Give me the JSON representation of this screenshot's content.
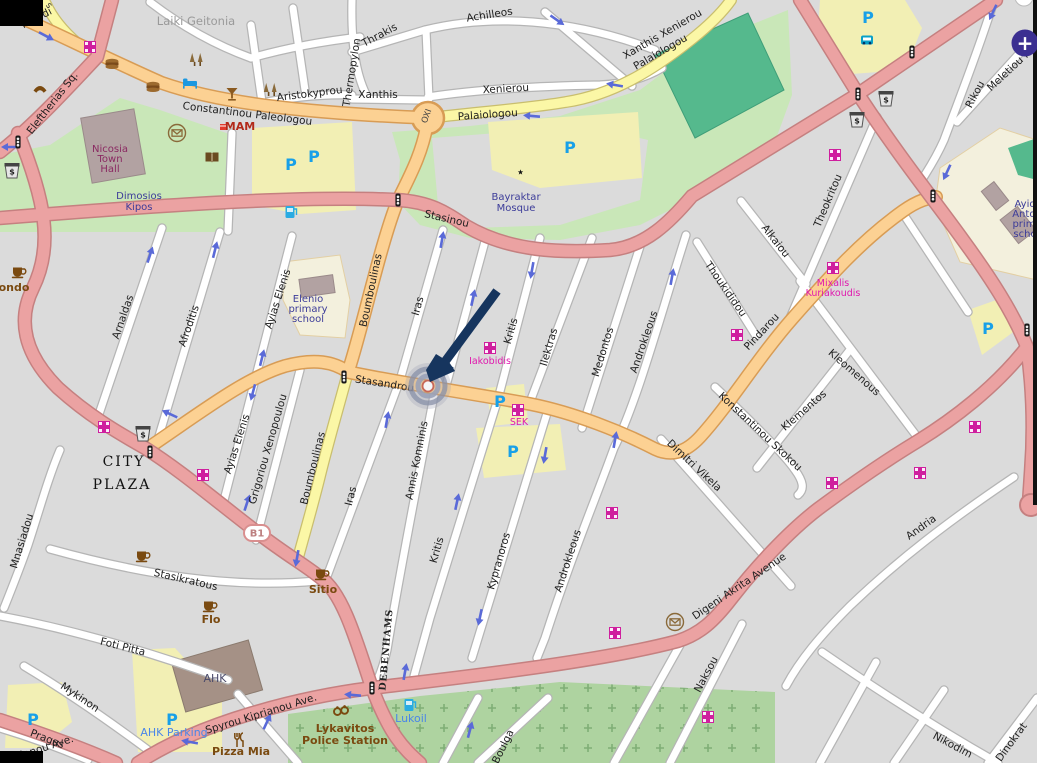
{
  "controls": {
    "zoom_in_glyph": "+"
  },
  "road_badge": {
    "text": "B1"
  },
  "icon_glyphs": {
    "parking": "P",
    "atm": "$"
  },
  "colors": {
    "road_pink": "#eba2a2",
    "road_orange": "#fcd193",
    "road_yellow": "#fbf7a6",
    "park_green": "#c9e7b8",
    "sports_field_teal": "#55b98d",
    "cemetery_green": "#aed3a0",
    "parking_area_yellow": "#f2efb4",
    "school_cream": "#f3f0dd",
    "building_mauve": "#b2a2a2",
    "pharmacy_magenta": "#cf1f9e",
    "parking_blue": "#18a0e8",
    "marker_arrow_navy": "#16355e",
    "zoom_button_purple": "#3b2f91",
    "oneway_arrow_blue": "#5a6ad8"
  },
  "labels": {
    "streets": [
      {
        "t": "ntelidi",
        "x": 38,
        "y": 21,
        "r": -27
      },
      {
        "t": "s",
        "x": 47,
        "y": 7,
        "r": 50,
        "c": "stsm"
      },
      {
        "t": "Eleftherias Sq.",
        "x": 55,
        "y": 105,
        "r": -52
      },
      {
        "t": "Constantinou Paleologou",
        "x": 247,
        "y": 117,
        "r": 7
      },
      {
        "t": "Aristokyprou",
        "x": 310,
        "y": 97,
        "r": -7
      },
      {
        "t": "Achilleos",
        "x": 490,
        "y": 18,
        "r": -9
      },
      {
        "t": "Thrakis",
        "x": 381,
        "y": 38,
        "r": -28
      },
      {
        "t": "Thermopylon",
        "x": 355,
        "y": 73,
        "r": -81
      },
      {
        "t": "Xanthis",
        "x": 378,
        "y": 98,
        "r": 0
      },
      {
        "t": "Xenierou",
        "x": 506,
        "y": 92,
        "r": -3
      },
      {
        "t": "Palaiologou",
        "x": 488,
        "y": 118,
        "r": -4
      },
      {
        "t": "Xanthis Xenierou",
        "x": 664,
        "y": 37,
        "r": -30
      },
      {
        "t": "Palaiologou",
        "x": 662,
        "y": 55,
        "r": -30
      },
      {
        "t": "Stasinou",
        "x": 446,
        "y": 222,
        "r": 13
      },
      {
        "t": "Meletiou M",
        "x": 1012,
        "y": 72,
        "r": -43
      },
      {
        "t": "Rikou",
        "x": 978,
        "y": 96,
        "r": -62
      },
      {
        "t": "Theokritou",
        "x": 831,
        "y": 202,
        "r": -67
      },
      {
        "t": "Alkaiou",
        "x": 773,
        "y": 243,
        "r": 52
      },
      {
        "t": "Thoukididou",
        "x": 723,
        "y": 291,
        "r": 55
      },
      {
        "t": "Pindarou",
        "x": 764,
        "y": 334,
        "r": -47
      },
      {
        "t": "Boumboulinas",
        "x": 374,
        "y": 291,
        "r": -78
      },
      {
        "t": "Boumboulinas",
        "x": 316,
        "y": 469,
        "r": -76
      },
      {
        "t": "Iras",
        "x": 421,
        "y": 307,
        "r": -74
      },
      {
        "t": "Iras",
        "x": 354,
        "y": 497,
        "r": -76
      },
      {
        "t": "Annis Komninis",
        "x": 420,
        "y": 461,
        "r": -79
      },
      {
        "t": "Kritis",
        "x": 514,
        "y": 332,
        "r": -74
      },
      {
        "t": "Kritis",
        "x": 440,
        "y": 551,
        "r": -74
      },
      {
        "t": "Ilektras",
        "x": 552,
        "y": 348,
        "r": -74
      },
      {
        "t": "Medontos",
        "x": 606,
        "y": 353,
        "r": -73
      },
      {
        "t": "Androkleous",
        "x": 647,
        "y": 343,
        "r": -71
      },
      {
        "t": "Kypranoros",
        "x": 502,
        "y": 562,
        "r": -74
      },
      {
        "t": "Androkleous",
        "x": 571,
        "y": 562,
        "r": -72
      },
      {
        "t": "Kleomenous",
        "x": 852,
        "y": 375,
        "r": 41
      },
      {
        "t": "Klementos",
        "x": 806,
        "y": 413,
        "r": -41
      },
      {
        "t": "Konstantinou Skokou",
        "x": 758,
        "y": 434,
        "r": 43
      },
      {
        "t": "Dimitri Vikela",
        "x": 692,
        "y": 468,
        "r": 43
      },
      {
        "t": "Stasandrou",
        "x": 384,
        "y": 387,
        "r": 9
      },
      {
        "t": "Ayias Elenis",
        "x": 281,
        "y": 300,
        "r": -72
      },
      {
        "t": "Ayias Elenis",
        "x": 240,
        "y": 445,
        "r": -72
      },
      {
        "t": "Grigoriou Xenopoulou",
        "x": 271,
        "y": 450,
        "r": -74
      },
      {
        "t": "Arnaldas",
        "x": 126,
        "y": 318,
        "r": -71
      },
      {
        "t": "Afroditis",
        "x": 192,
        "y": 327,
        "r": -71
      },
      {
        "t": "Mnasiadou",
        "x": 25,
        "y": 542,
        "r": -73
      },
      {
        "t": "Stasikratous",
        "x": 185,
        "y": 583,
        "r": 13
      },
      {
        "t": "Foti Pitta",
        "x": 122,
        "y": 650,
        "r": 14
      },
      {
        "t": "Mykinon",
        "x": 78,
        "y": 700,
        "r": 34
      },
      {
        "t": "Pragas",
        "x": 46,
        "y": 742,
        "r": 21
      },
      {
        "t": "Digeni Akrita Avenue",
        "x": 741,
        "y": 589,
        "r": -34
      },
      {
        "t": "Spyrou Kiprianou Ave.",
        "x": 262,
        "y": 717,
        "r": -17
      },
      {
        "t": "ianou Ave.",
        "x": 48,
        "y": 750,
        "r": -18
      },
      {
        "t": "Andria",
        "x": 923,
        "y": 530,
        "r": -36
      },
      {
        "t": "Naksou",
        "x": 709,
        "y": 676,
        "r": -62
      },
      {
        "t": "Nikodim",
        "x": 951,
        "y": 748,
        "r": 28
      },
      {
        "t": "Dinokrat",
        "x": 1014,
        "y": 744,
        "r": -54
      },
      {
        "t": "Boulga",
        "x": 506,
        "y": 748,
        "r": -64
      },
      {
        "t": "OXI",
        "x": 429,
        "y": 117,
        "r": -70,
        "c": "oxi"
      },
      {
        "t": "Laiki Geitonia",
        "x": 196,
        "y": 25,
        "r": 0,
        "c": "gray"
      },
      {
        "t": "DEBENHAMS",
        "x": 389,
        "y": 650,
        "r": -85,
        "c": "deb"
      }
    ],
    "places": [
      {
        "t": "Nicosia",
        "x": 110,
        "y": 152,
        "c": "maroon"
      },
      {
        "t": "Town",
        "x": 110,
        "y": 162,
        "c": "maroon"
      },
      {
        "t": "Hall",
        "x": 110,
        "y": 172,
        "c": "maroon"
      },
      {
        "t": "Dimosios",
        "x": 139,
        "y": 199,
        "c": "navy"
      },
      {
        "t": "Kipos",
        "x": 139,
        "y": 210,
        "c": "navy"
      },
      {
        "t": "Bayraktar",
        "x": 516,
        "y": 200,
        "c": "navy"
      },
      {
        "t": "Mosque",
        "x": 516,
        "y": 211,
        "c": "navy"
      },
      {
        "t": "Elenio",
        "x": 308,
        "y": 302,
        "c": "navy"
      },
      {
        "t": "primary",
        "x": 308,
        "y": 312,
        "c": "navy"
      },
      {
        "t": "school",
        "x": 308,
        "y": 322,
        "c": "navy"
      },
      {
        "t": "Ayio",
        "x": 1025,
        "y": 207,
        "c": "navy"
      },
      {
        "t": "Anton",
        "x": 1027,
        "y": 217,
        "c": "navy"
      },
      {
        "t": "prima",
        "x": 1027,
        "y": 227,
        "c": "navy"
      },
      {
        "t": "scho",
        "x": 1025,
        "y": 237,
        "c": "navy"
      },
      {
        "t": "CITY",
        "x": 124,
        "y": 466,
        "c": "serif"
      },
      {
        "t": "PLAZA",
        "x": 122,
        "y": 489,
        "c": "serif"
      },
      {
        "t": "AHK",
        "x": 215,
        "y": 682,
        "c": "slate"
      },
      {
        "t": "Lykavitos",
        "x": 345,
        "y": 732,
        "c": "brb"
      },
      {
        "t": "Police Station",
        "x": 345,
        "y": 744,
        "c": "brb"
      },
      {
        "t": "Mixalis",
        "x": 833,
        "y": 286,
        "c": "mag"
      },
      {
        "t": "Kuriakoudis",
        "x": 833,
        "y": 296,
        "c": "mag"
      },
      {
        "t": "Iakobidis",
        "x": 490,
        "y": 364,
        "c": "mag"
      },
      {
        "t": "SEK",
        "x": 519,
        "y": 425,
        "c": "mag"
      },
      {
        "t": "MAM",
        "x": 240,
        "y": 130,
        "c": "redbold"
      },
      {
        "t": "ondo",
        "x": 14,
        "y": 291,
        "c": "brb"
      },
      {
        "t": "Flo",
        "x": 211,
        "y": 623,
        "c": "brb"
      },
      {
        "t": "Sitio",
        "x": 323,
        "y": 593,
        "c": "brb"
      },
      {
        "t": "Pizza Mia",
        "x": 241,
        "y": 755,
        "c": "brb"
      },
      {
        "t": "AHK Parking",
        "x": 174,
        "y": 736,
        "c": "blue"
      },
      {
        "t": "Lukoil",
        "x": 411,
        "y": 722,
        "c": "blue"
      }
    ]
  },
  "icons": [
    {
      "t": "pharmacy",
      "x": 90,
      "y": 47
    },
    {
      "t": "pharmacy",
      "x": 835,
      "y": 155
    },
    {
      "t": "pharmacy",
      "x": 104,
      "y": 427
    },
    {
      "t": "pharmacy",
      "x": 203,
      "y": 475
    },
    {
      "t": "pharmacy",
      "x": 490,
      "y": 348
    },
    {
      "t": "pharmacy",
      "x": 518,
      "y": 410
    },
    {
      "t": "pharmacy",
      "x": 833,
      "y": 268
    },
    {
      "t": "pharmacy",
      "x": 737,
      "y": 335
    },
    {
      "t": "pharmacy",
      "x": 975,
      "y": 427
    },
    {
      "t": "pharmacy",
      "x": 920,
      "y": 473
    },
    {
      "t": "pharmacy",
      "x": 832,
      "y": 483
    },
    {
      "t": "pharmacy",
      "x": 612,
      "y": 513
    },
    {
      "t": "pharmacy",
      "x": 615,
      "y": 633
    },
    {
      "t": "pharmacy",
      "x": 708,
      "y": 717
    },
    {
      "t": "parking",
      "x": 291,
      "y": 164
    },
    {
      "t": "parking",
      "x": 314,
      "y": 156
    },
    {
      "t": "parking",
      "x": 570,
      "y": 147
    },
    {
      "t": "parking",
      "x": 868,
      "y": 17
    },
    {
      "t": "parking",
      "x": 500,
      "y": 401
    },
    {
      "t": "parking",
      "x": 513,
      "y": 451
    },
    {
      "t": "parking",
      "x": 988,
      "y": 328
    },
    {
      "t": "parking",
      "x": 33,
      "y": 719
    },
    {
      "t": "parking",
      "x": 172,
      "y": 719
    },
    {
      "t": "traffic-light",
      "x": 18,
      "y": 142
    },
    {
      "t": "traffic-light",
      "x": 398,
      "y": 200
    },
    {
      "t": "traffic-light",
      "x": 858,
      "y": 94
    },
    {
      "t": "traffic-light",
      "x": 912,
      "y": 52
    },
    {
      "t": "traffic-light",
      "x": 933,
      "y": 196
    },
    {
      "t": "traffic-light",
      "x": 1027,
      "y": 330
    },
    {
      "t": "traffic-light",
      "x": 150,
      "y": 452
    },
    {
      "t": "traffic-light",
      "x": 344,
      "y": 377
    },
    {
      "t": "traffic-light",
      "x": 372,
      "y": 688
    },
    {
      "t": "atm",
      "x": 12,
      "y": 171
    },
    {
      "t": "atm",
      "x": 143,
      "y": 434
    },
    {
      "t": "atm",
      "x": 886,
      "y": 99
    },
    {
      "t": "atm",
      "x": 857,
      "y": 120
    },
    {
      "t": "bus-stop",
      "x": 867,
      "y": 40
    },
    {
      "t": "fast-food",
      "x": 112,
      "y": 64
    },
    {
      "t": "fast-food",
      "x": 153,
      "y": 87
    },
    {
      "t": "hotel",
      "x": 190,
      "y": 83
    },
    {
      "t": "bar",
      "x": 232,
      "y": 94
    },
    {
      "t": "trees",
      "x": 197,
      "y": 60
    },
    {
      "t": "trees",
      "x": 271,
      "y": 90
    },
    {
      "t": "telephone",
      "x": 40,
      "y": 88
    },
    {
      "t": "post-office",
      "x": 177,
      "y": 133
    },
    {
      "t": "post-office",
      "x": 675,
      "y": 622
    },
    {
      "t": "library",
      "x": 212,
      "y": 157
    },
    {
      "t": "mosque",
      "x": 516,
      "y": 172
    },
    {
      "t": "fuel",
      "x": 290,
      "y": 212
    },
    {
      "t": "fuel",
      "x": 409,
      "y": 705
    },
    {
      "t": "cafe",
      "x": 18,
      "y": 272
    },
    {
      "t": "cafe",
      "x": 321,
      "y": 574
    },
    {
      "t": "cafe",
      "x": 209,
      "y": 606
    },
    {
      "t": "cafe",
      "x": 142,
      "y": 556
    },
    {
      "t": "police",
      "x": 341,
      "y": 711
    },
    {
      "t": "restaurant",
      "x": 240,
      "y": 740
    },
    {
      "t": "shop",
      "x": 223,
      "y": 127
    }
  ],
  "oneway_arrows": [
    {
      "x": 46,
      "y": 36,
      "r": 28
    },
    {
      "x": 10,
      "y": 147,
      "r": 180
    },
    {
      "x": 557,
      "y": 20,
      "r": 35
    },
    {
      "x": 615,
      "y": 85,
      "r": 190
    },
    {
      "x": 532,
      "y": 116,
      "r": 185
    },
    {
      "x": 442,
      "y": 240,
      "r": -80
    },
    {
      "x": 473,
      "y": 298,
      "r": -78
    },
    {
      "x": 532,
      "y": 270,
      "r": 100
    },
    {
      "x": 672,
      "y": 277,
      "r": -80
    },
    {
      "x": 615,
      "y": 440,
      "r": -80
    },
    {
      "x": 545,
      "y": 455,
      "r": 100
    },
    {
      "x": 150,
      "y": 255,
      "r": -72
    },
    {
      "x": 215,
      "y": 250,
      "r": -76
    },
    {
      "x": 262,
      "y": 358,
      "r": -76
    },
    {
      "x": 253,
      "y": 392,
      "r": 105
    },
    {
      "x": 170,
      "y": 414,
      "r": 205
    },
    {
      "x": 387,
      "y": 420,
      "r": -80
    },
    {
      "x": 247,
      "y": 503,
      "r": -72
    },
    {
      "x": 297,
      "y": 558,
      "r": 100
    },
    {
      "x": 267,
      "y": 722,
      "r": -65
    },
    {
      "x": 993,
      "y": 12,
      "r": 115
    },
    {
      "x": 947,
      "y": 172,
      "r": 115
    },
    {
      "x": 457,
      "y": 502,
      "r": -78
    },
    {
      "x": 480,
      "y": 617,
      "r": 102
    },
    {
      "x": 405,
      "y": 672,
      "r": -80
    },
    {
      "x": 353,
      "y": 695,
      "r": 185
    },
    {
      "x": 190,
      "y": 742,
      "r": 190
    },
    {
      "x": 470,
      "y": 730,
      "r": -75
    }
  ]
}
